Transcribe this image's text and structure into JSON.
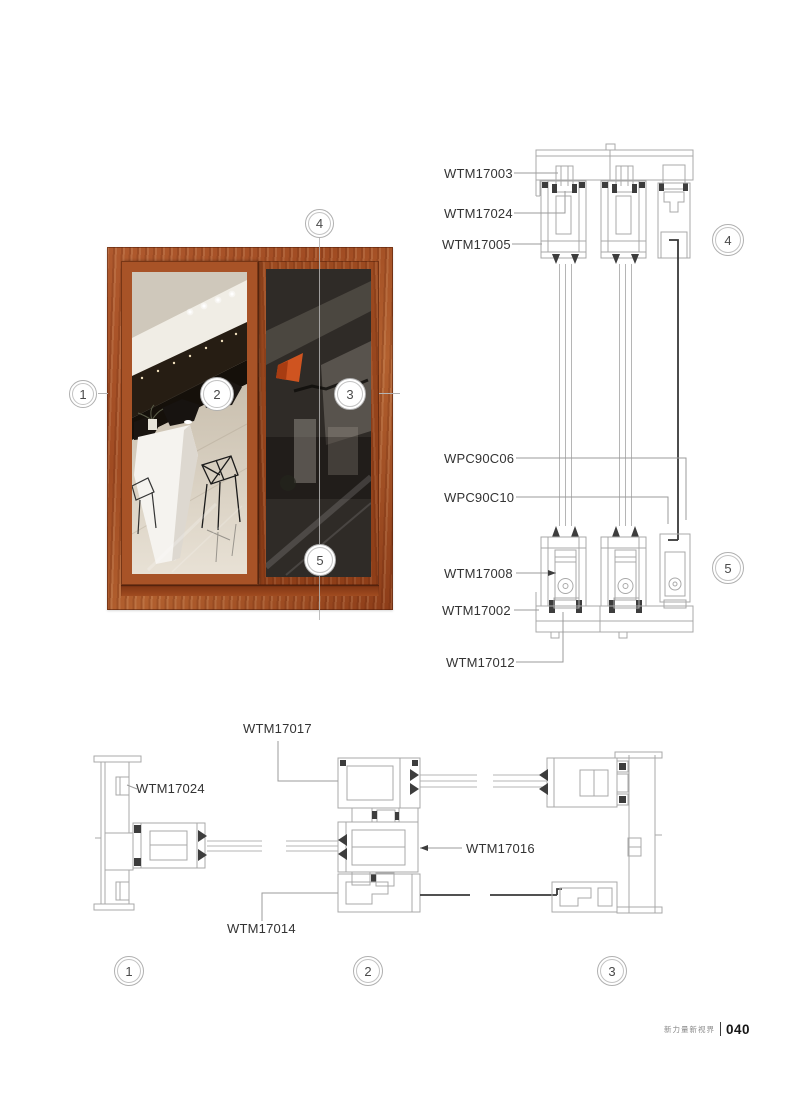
{
  "photo": {
    "callouts": [
      {
        "number": "1"
      },
      {
        "number": "2"
      },
      {
        "number": "3"
      },
      {
        "number": "4"
      },
      {
        "number": "5"
      }
    ]
  },
  "vertical_section": {
    "part_labels": [
      {
        "part": "WTM17003"
      },
      {
        "part": "WTM17024"
      },
      {
        "part": "WTM17005"
      },
      {
        "part": "WPC90C06"
      },
      {
        "part": "WPC90C10"
      },
      {
        "part": "WTM17008"
      },
      {
        "part": "WTM17002"
      },
      {
        "part": "WTM17012"
      }
    ],
    "section_markers": [
      {
        "number": "4"
      },
      {
        "number": "5"
      }
    ]
  },
  "horizontal_section": {
    "part_labels": [
      {
        "part": "WTM17017"
      },
      {
        "part": "WTM17024"
      },
      {
        "part": "WTM17016"
      },
      {
        "part": "WTM17014"
      }
    ],
    "section_markers": [
      {
        "number": "1"
      },
      {
        "number": "2"
      },
      {
        "number": "3"
      }
    ]
  },
  "footer": {
    "brand_text": "新力量新视界",
    "page_number": "040"
  },
  "colors": {
    "wood_frame": "#a6502a",
    "drawing_line": "#a9a9a9",
    "drawing_dark": "#3d3d3d",
    "screen_mesh": "#2f2b27",
    "label_text": "#333333"
  }
}
